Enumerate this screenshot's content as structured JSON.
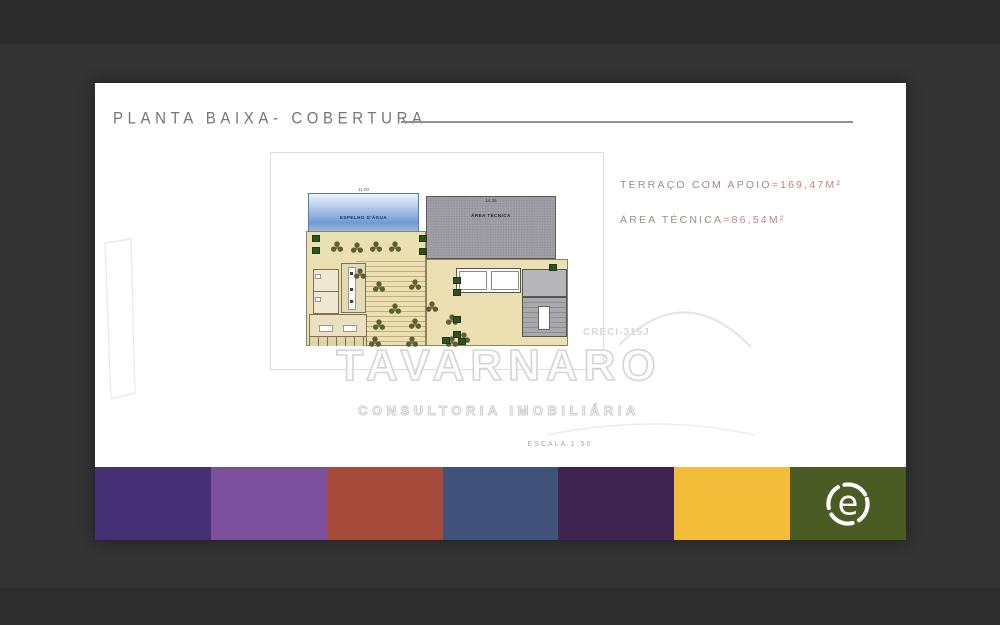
{
  "page": {
    "title": "PLANTA BAIXA- COBERTURA",
    "scale_note": "ESCALA 1:50"
  },
  "areas": {
    "line1_label": "TERRAÇO COM APOIO",
    "line1_value": "=169,47M²",
    "line2_label": "ÁREA TÉCNICA",
    "line2_value": "=86,54M²"
  },
  "watermark": {
    "brand": "TAVARNARO",
    "tagline": "CONSULTORIA IMOBILIÁRIA",
    "creci": "CRECI-315J"
  },
  "plan": {
    "water_label": "ESPELHO D'ÁGUA",
    "water_dim": "11.00",
    "tech_label": "ÁREA TÉCNICA",
    "tech_dim": "14.35"
  },
  "logo": {
    "letter": "e",
    "background": "#4a5c24",
    "foreground": "#ffffff"
  },
  "palette": [
    {
      "name": "dark-violet",
      "hex": "#453076"
    },
    {
      "name": "medium-purple",
      "hex": "#7b4f9c"
    },
    {
      "name": "brick-red",
      "hex": "#a64a3c"
    },
    {
      "name": "steel-blue",
      "hex": "#41527a"
    },
    {
      "name": "eggplant",
      "hex": "#3f2350"
    },
    {
      "name": "golden-yellow",
      "hex": "#f3bd3a"
    },
    {
      "name": "olive-green",
      "hex": "#4a5c24"
    }
  ],
  "colors": {
    "background": "#343434",
    "annotation_value_accent": "#c8816c",
    "watermark_gray": "#d4d4d4"
  }
}
